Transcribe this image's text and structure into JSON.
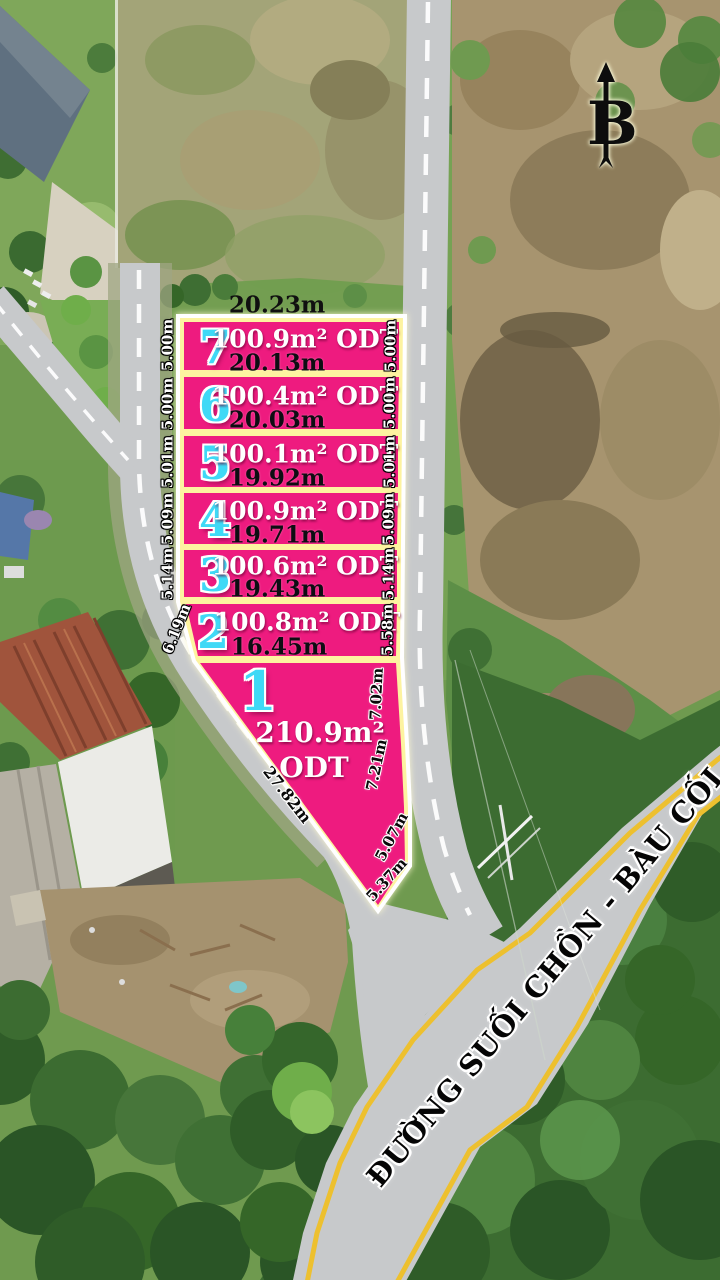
{
  "north_marker": {
    "label": "B"
  },
  "boundary_top": {
    "length": "20.23m"
  },
  "road": {
    "name": "ĐƯỜNG SUỐI CHỒN - BÀU CỐI"
  },
  "plots": [
    {
      "number": "7",
      "area": "100.9m² ODT",
      "frontage": "20.13m",
      "side_left": "5.00m",
      "side_right": "5.00m"
    },
    {
      "number": "6",
      "area": "100.4m² ODT",
      "frontage": "20.03m",
      "side_left": "5.00m",
      "side_right": "5.00m"
    },
    {
      "number": "5",
      "area": "100.1m² ODT",
      "frontage": "19.92m",
      "side_left": "5.01m",
      "side_right": "5.01m"
    },
    {
      "number": "4",
      "area": "100.9m² ODT",
      "frontage": "19.71m",
      "side_left": "5.09m",
      "side_right": "5.09m"
    },
    {
      "number": "3",
      "area": "100.6m² ODT",
      "frontage": "19.43m",
      "side_left": "5.14m",
      "side_right": "5.14m"
    },
    {
      "number": "2",
      "area": "100.8m² ODT",
      "frontage": "16.45m",
      "side_left": "6.19m",
      "side_right": "5.58m"
    },
    {
      "number": "1",
      "area": "210.9m²",
      "zoning": "ODT",
      "side_left": "27.82m",
      "sides_right": [
        "7.02m",
        "7.21m",
        "5.07m",
        "5.37m"
      ]
    }
  ],
  "colors": {
    "plot_fill": "#ee1b7f",
    "plot_number": "#3fd9f6",
    "plot_boundary": "#fdf3a0",
    "road_edge_line": "#edc02f"
  }
}
